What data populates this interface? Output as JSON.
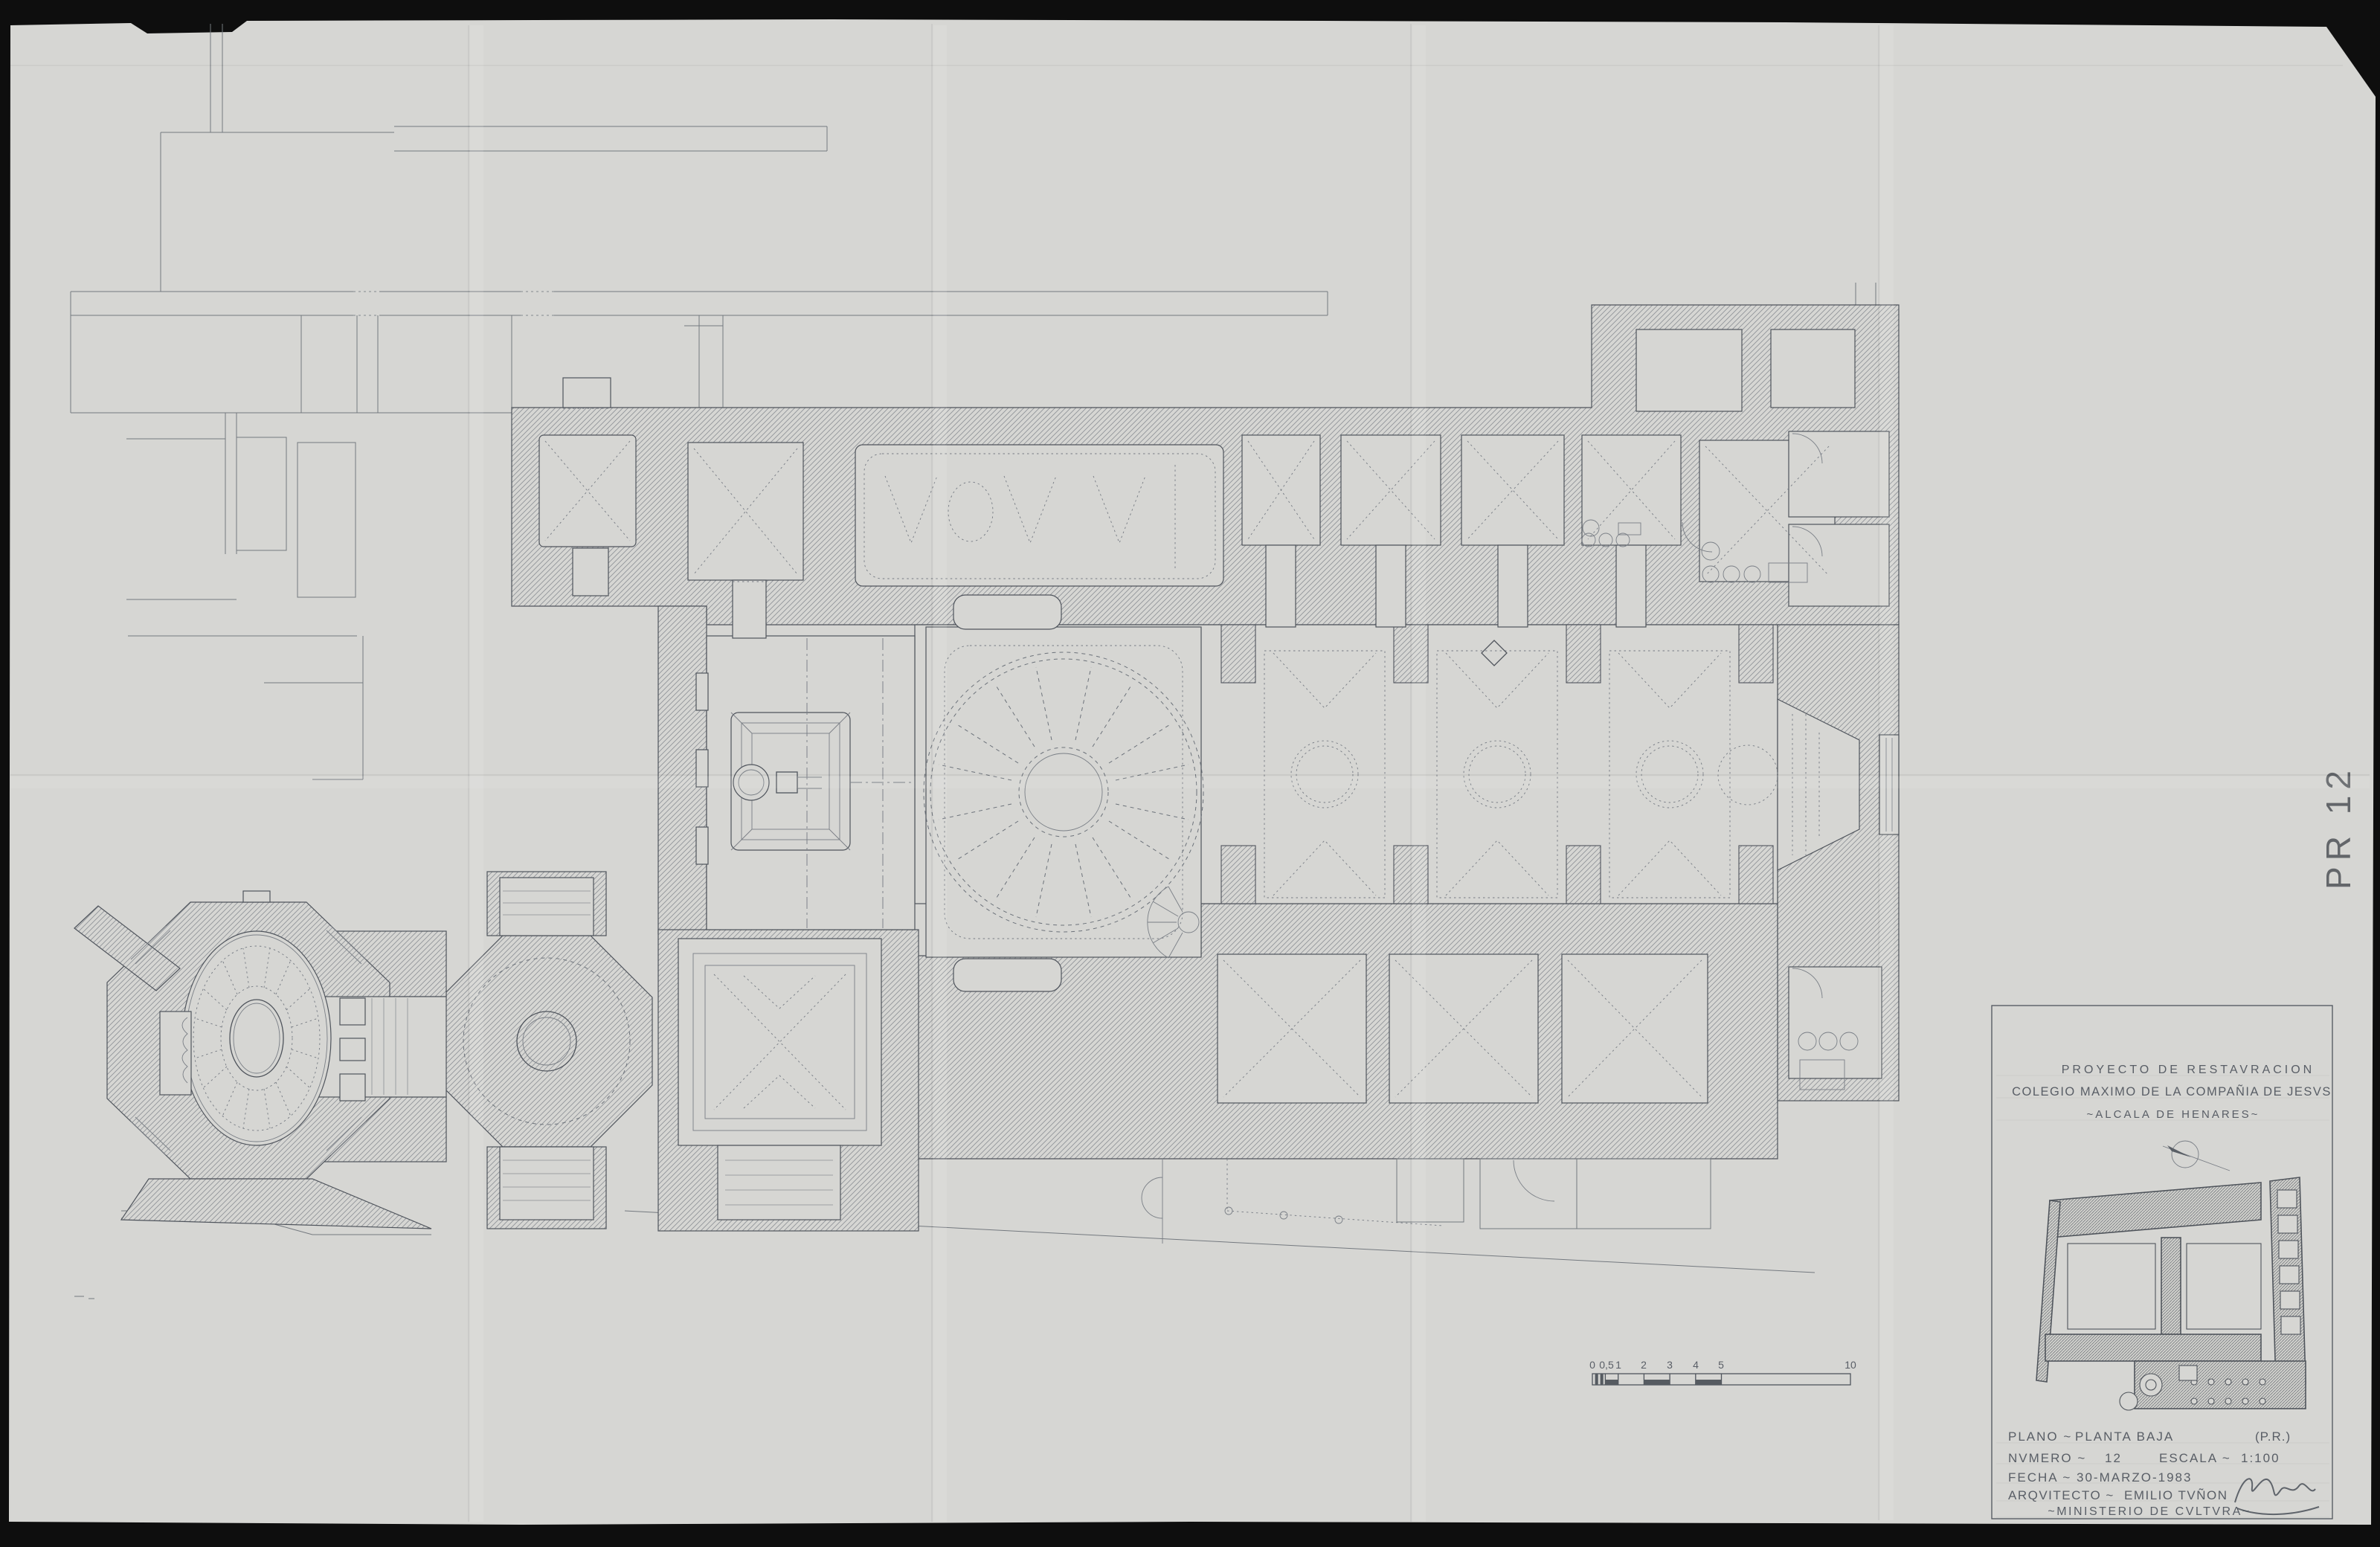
{
  "sheet": {
    "code": "PR 12",
    "paper_color": "#d6d6d3",
    "background_color": "#0e0e0e",
    "ink_color": "#53585f"
  },
  "title_block": {
    "project": {
      "line1": "PROYECTO DE RESTAVRACION",
      "line2": "COLEGIO MAXIMO DE LA COMPAÑIA DE JESVS",
      "line3": "~ALCALA DE HENARES~"
    },
    "fields": {
      "plano_label": "PLANO ~",
      "plano_value": "PLANTA BAJA",
      "plano_ref": "(P.R.)",
      "numero_label": "NVMERO ~",
      "numero_value": "12",
      "escala_label": "ESCALA ~",
      "escala_value": "1:100",
      "fecha_label": "FECHA ~",
      "fecha_value": "30-MARZO-1983",
      "arquitecto_label": "ARQVITECTO ~",
      "arquitecto_value": "EMILIO TVÑON",
      "ministerio": "~MINISTERIO DE CVLTVRA~"
    }
  },
  "scale_bar": {
    "labels": [
      "0",
      "0,5",
      "1",
      "2",
      "3",
      "4",
      "5",
      "10"
    ]
  }
}
